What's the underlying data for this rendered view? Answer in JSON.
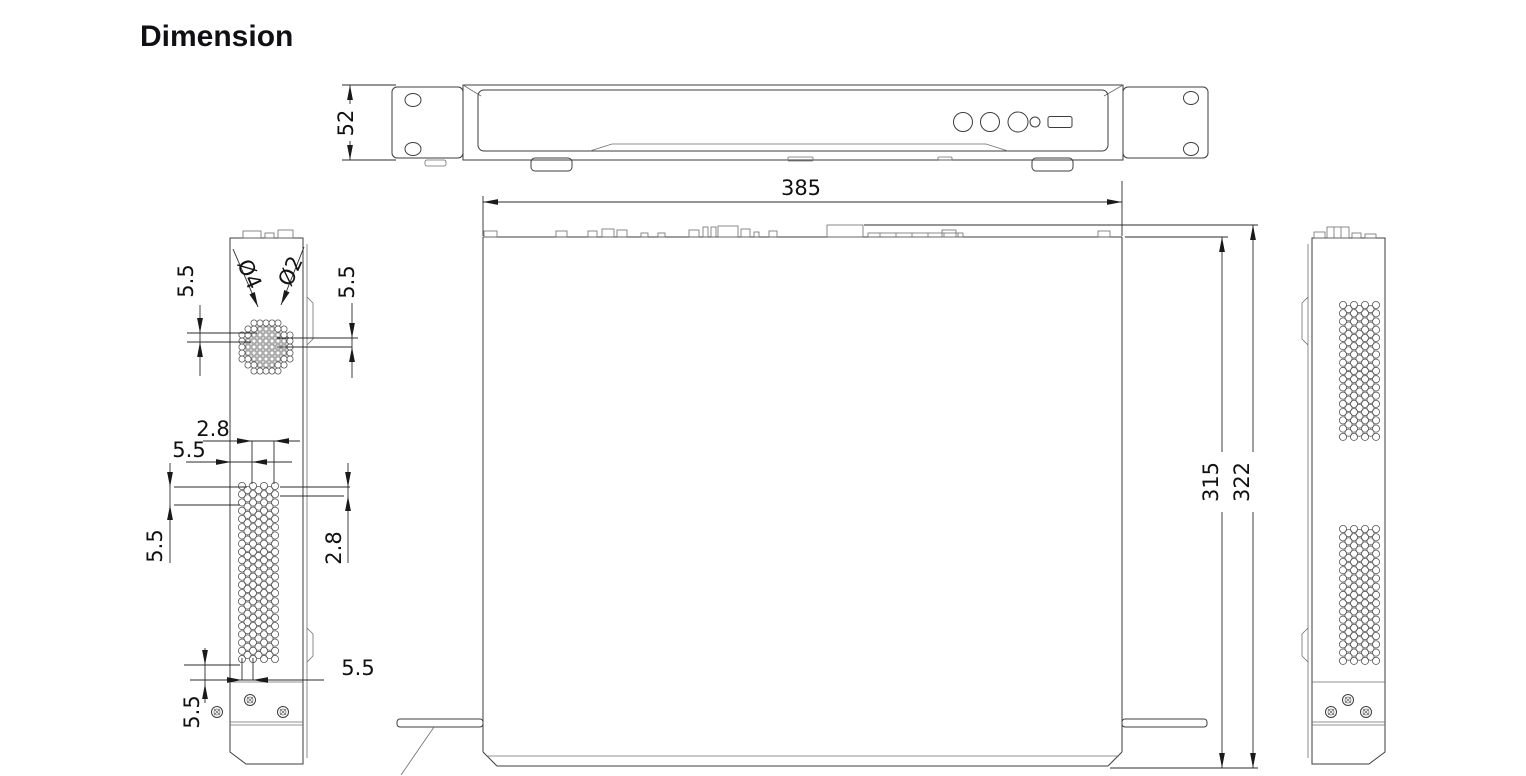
{
  "title": "Dimension",
  "dims": {
    "front_height": "52",
    "width": "385",
    "depth_inner": "315",
    "depth_outer": "322",
    "fan_hole_outer": "Ø4",
    "fan_hole_inner": "Ø2",
    "fan_offset_left": "5.5",
    "fan_offset_right": "5.5",
    "vent_col_pitch": "2.8",
    "vent_col_offset": "5.5",
    "vent_row_left": "5.5",
    "vent_row_right": "2.8",
    "vent_bottom_left": "5.5",
    "vent_bottom_right": "5.5"
  }
}
